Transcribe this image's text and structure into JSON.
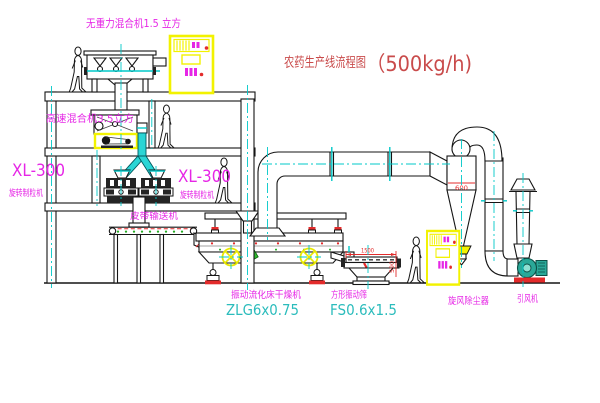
{
  "diagram": {
    "title": {
      "name": "农药生产线流程图",
      "capacity": "（500kg/h)"
    },
    "equipment": {
      "no_gravity_mixer": {
        "label": "无重力混合机1.5 立方"
      },
      "high_speed_mixer": {
        "label": "高速混合机3.5立方"
      },
      "granulator_left": {
        "model": "XL-300",
        "name": "旋转制粒机"
      },
      "granulator_right": {
        "model": "XL-300",
        "name": "旋转制粒机"
      },
      "belt_conveyor": {
        "name": "皮带输送机"
      },
      "fluid_bed_dryer": {
        "name": "振动流化床干燥机",
        "model": "ZLG6x0.75"
      },
      "vibrating_sieve": {
        "name": "方形振动筛",
        "model": "FS0.6x1.5"
      },
      "cyclone": {
        "name": "旋风除尘器"
      },
      "fan": {
        "name": "引风机"
      }
    },
    "dimensions": {
      "sieve_length": "1500",
      "sieve_height": "590",
      "cyclone_diameter": "600"
    },
    "colors": {
      "label_magenta": "#e626e6",
      "title_red": "#c94b4b",
      "model_cyan": "#2bbcbc",
      "centerline_cyan": "#00c8c8",
      "highlight_yellow": "#f2f200",
      "accent_red": "#e32b2b",
      "chute_cyan": "#2ad5d5",
      "fan_teal": "#2aa898",
      "tag_green": "#2ebb2e",
      "line_black": "#151515"
    }
  }
}
